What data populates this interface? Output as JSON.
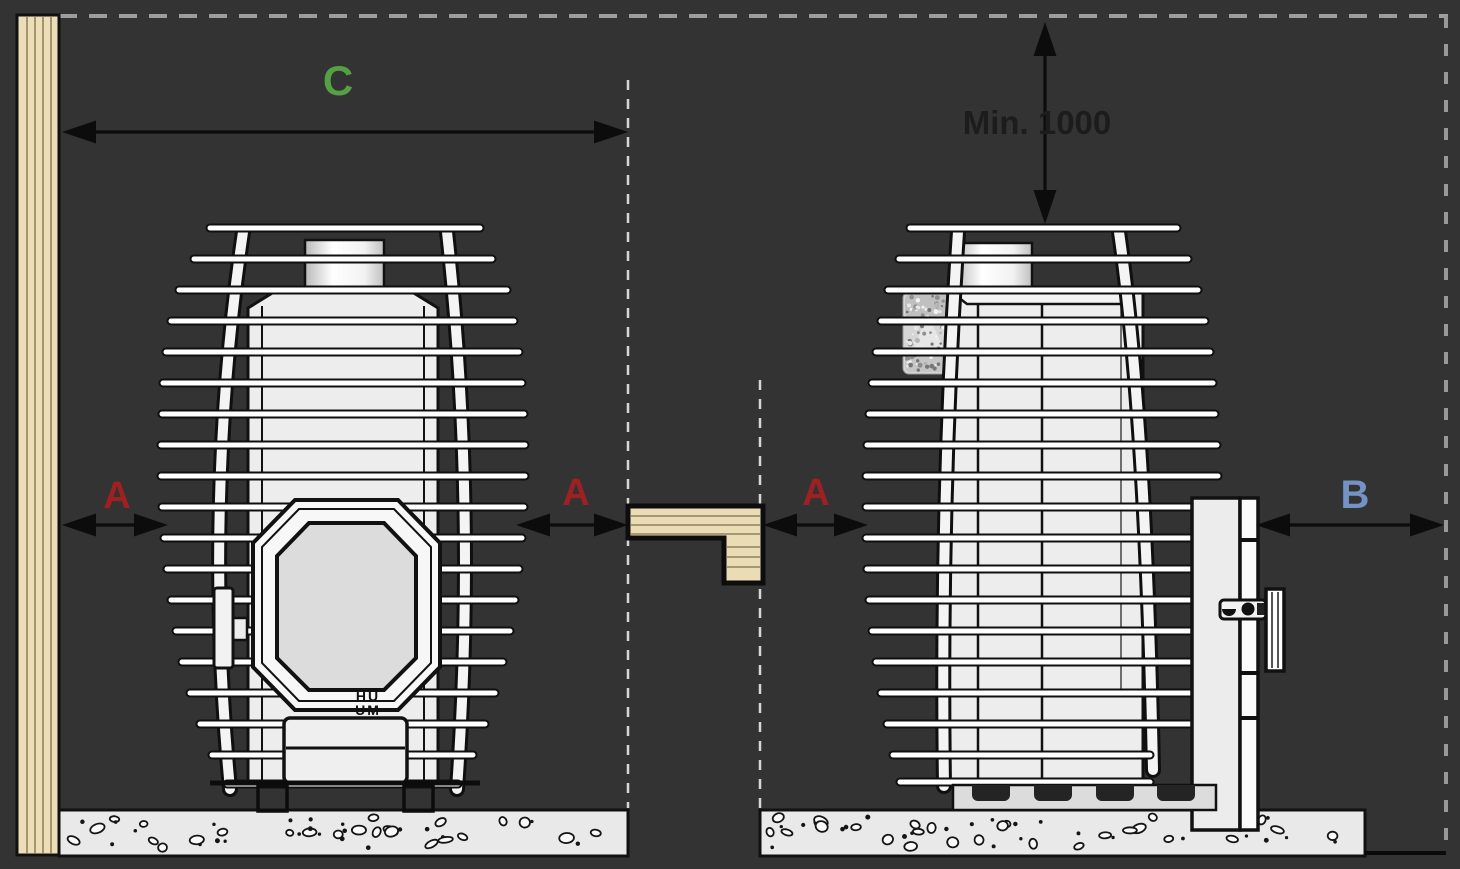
{
  "diagram": {
    "title": "sauna-stove-clearance-diagram",
    "labels": {
      "dim_a_left": "A",
      "dim_a_mid": "A",
      "dim_a_right": "A",
      "dim_b": "B",
      "dim_c": "C",
      "min_distance": "Min. 1000"
    },
    "logo": {
      "line1": "HU",
      "line2": "UM"
    },
    "colors": {
      "background": "#333333",
      "label_a": "#9e2020",
      "label_b": "#7293c3",
      "label_c": "#55a045",
      "label_min": "#1c1c1c",
      "wood": "#ecdeb8",
      "bench_wood": "#eadcb4",
      "stove_body": "#ededed",
      "concrete": "#e9e9e9",
      "line": "#0d0d0d"
    }
  }
}
